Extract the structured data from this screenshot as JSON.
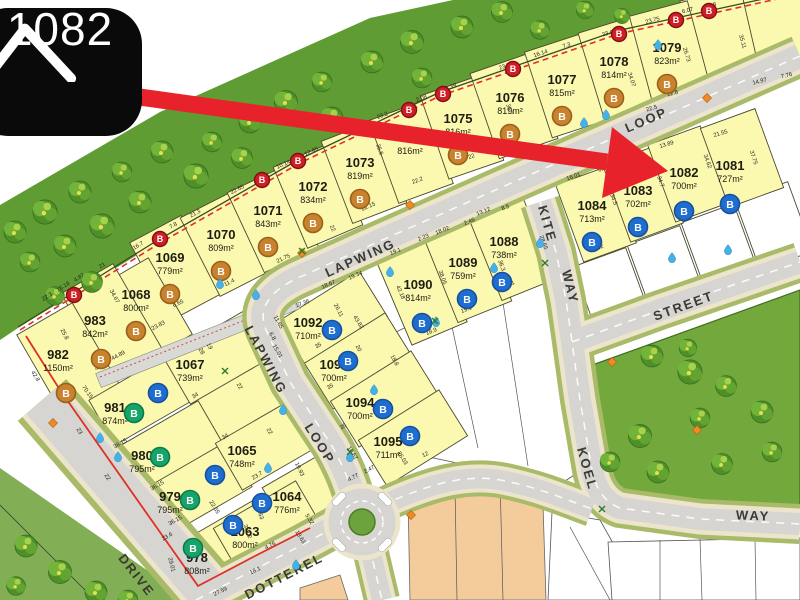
{
  "callout": {
    "lot_number": "1082"
  },
  "map": {
    "streets": [
      "LAPWING",
      "LOOP",
      "LAPWING",
      "LOOP",
      "KITE",
      "WAY",
      "STREET",
      "KOEL",
      "WAY",
      "DOTTEREL",
      "DRIVE"
    ],
    "badge_letter": "B",
    "boundary_marker_letter": "B",
    "lots": [
      {
        "id": "1069",
        "area": "779m²",
        "badge": "bronze"
      },
      {
        "id": "1070",
        "area": "809m²",
        "badge": "bronze"
      },
      {
        "id": "1071",
        "area": "843m²",
        "badge": "bronze"
      },
      {
        "id": "1072",
        "area": "834m²",
        "badge": "bronze"
      },
      {
        "id": "1073",
        "area": "819m²",
        "badge": "bronze"
      },
      {
        "id": "",
        "area": "816m²",
        "badge": ""
      },
      {
        "id": "1075",
        "area": "816m²",
        "badge": "bronze"
      },
      {
        "id": "1076",
        "area": "819m²",
        "badge": "bronze"
      },
      {
        "id": "1077",
        "area": "815m²",
        "badge": "bronze"
      },
      {
        "id": "1078",
        "area": "814m²",
        "badge": "bronze"
      },
      {
        "id": "1079",
        "area": "823m²",
        "badge": "bronze"
      },
      {
        "id": "1084",
        "area": "713m²",
        "badge": "blue"
      },
      {
        "id": "1083",
        "area": "702m²",
        "badge": "blue"
      },
      {
        "id": "1082",
        "area": "700m²",
        "badge": "blue"
      },
      {
        "id": "1081",
        "area": "727m²",
        "badge": "blue"
      },
      {
        "id": "1090",
        "area": "814m²",
        "badge": "blue"
      },
      {
        "id": "1089",
        "area": "759m²",
        "badge": "blue"
      },
      {
        "id": "1088",
        "area": "738m²",
        "badge": "blue"
      },
      {
        "id": "1092",
        "area": "710m²",
        "badge": "blue"
      },
      {
        "id": "1093",
        "area": "700m²",
        "badge": "blue"
      },
      {
        "id": "1094",
        "area": "700m²",
        "badge": "blue"
      },
      {
        "id": "1095",
        "area": "711m²",
        "badge": "blue"
      },
      {
        "id": "1068",
        "area": "800m²",
        "badge": "bronze"
      },
      {
        "id": "983",
        "area": "842m²",
        "badge": "bronze"
      },
      {
        "id": "982",
        "area": "1150m²",
        "badge": "bronze"
      },
      {
        "id": "981",
        "area": "874m²",
        "badge": "green"
      },
      {
        "id": "980",
        "area": "795m²",
        "badge": "green"
      },
      {
        "id": "979",
        "area": "795m²",
        "badge": "green"
      },
      {
        "id": "978",
        "area": "808m²",
        "badge": "green"
      },
      {
        "id": "1067",
        "area": "739m²",
        "badge": "blue"
      },
      {
        "id": "1065",
        "area": "748m²",
        "badge": "blue"
      },
      {
        "id": "1064",
        "area": "776m²",
        "badge": "blue"
      },
      {
        "id": "1063",
        "area": "800m²",
        "badge": "blue"
      }
    ],
    "dimensions": [
      "22.3",
      "16.18",
      "4.87",
      "21",
      "16.7",
      "7.8",
      "21.3",
      "22.65",
      "10.14",
      "12.65",
      "23.2",
      "2.08",
      "21.39",
      "23.5",
      "16.14",
      "7.3",
      "23.8",
      "23.75",
      "6.07",
      "17.8",
      "35.11",
      "26.73",
      "34.07",
      "22.8",
      "22.5",
      "14.97",
      "7.76",
      "21.55",
      "13.89",
      "16.01",
      "6.86",
      "34.5",
      "34.7",
      "34.62",
      "37.75",
      "19.62",
      "19",
      "19.6",
      "18.8",
      "2.46",
      "13.12",
      "8.5",
      "18.02",
      "2.23",
      "19.1",
      "28.65",
      "36.3",
      "38.05",
      "42.18",
      "18.9",
      "19.1",
      "21",
      "17.36",
      "26.11",
      "43.82",
      "35",
      "35",
      "35",
      "20",
      "18.8",
      "26.03",
      "10.57",
      "2.47",
      "4.77",
      "11.65",
      "6.8",
      "15.01",
      "34.67",
      "25.8",
      "42.8",
      "70.15",
      "4.24",
      "23.83",
      "44.89",
      "4.24",
      "6.65",
      "19",
      "28",
      "23",
      "22",
      "38.15",
      "36.15",
      "36.15",
      "23.6",
      "22.65",
      "34",
      "22",
      "34",
      "22",
      "23.7",
      "19.93",
      "34.63",
      "35.02",
      "4.76",
      "13.63",
      "5.32",
      "18.1",
      "27.59",
      "11.4",
      "21.75",
      "22",
      "22.15",
      "19.34",
      "18.67",
      "22.2",
      "22",
      "35.6",
      "36.7",
      "12",
      "29.01"
    ],
    "colors": {
      "lot_fill": "#fbf8b0",
      "road": "#d6d5d1",
      "verge": "#a9ba68",
      "sidewalk": "#ece5cb",
      "forest": "#5f9c33",
      "park": "#73a83d",
      "orange_lot": "#f4cc9c",
      "boundary_red": "#e03026",
      "arrow_red": "#e8222a",
      "badge_bronze": "#c9822e",
      "badge_green": "#16a469",
      "badge_blue": "#1e6ed0",
      "badge_red": "#cf1f26",
      "callout_bg": "#0a0a0a",
      "water_drop": "#45b1e8"
    }
  }
}
